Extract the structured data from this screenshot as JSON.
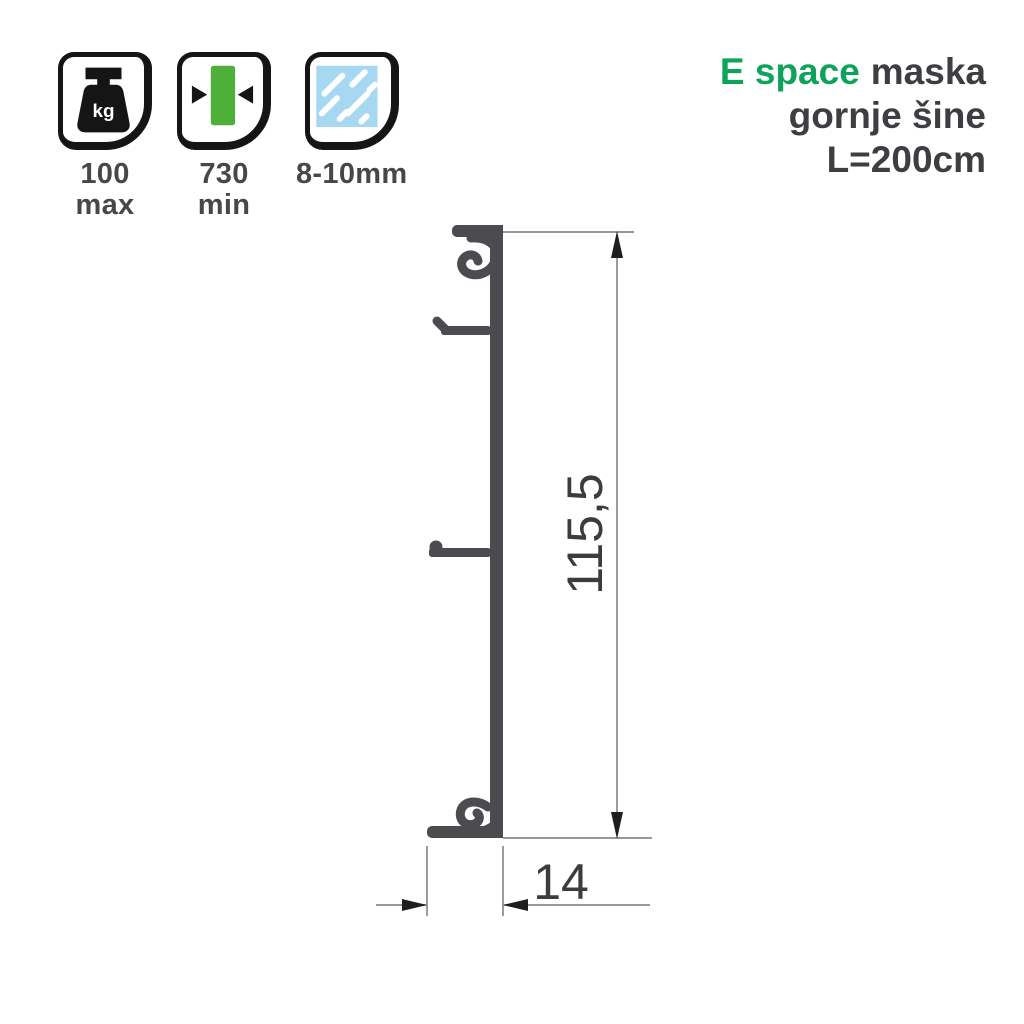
{
  "colors": {
    "ink": "#151515",
    "accent-green": "#0ea35a",
    "icon-green": "#4eb038",
    "glass-blue": "#a6d8f2",
    "text-dark": "#3e3e42",
    "label-gray": "#474747",
    "profile-gray": "#4b4b50",
    "dim-line-gray": "#8a8a8a",
    "dim-arrow-dark": "#1e1e1e",
    "dim-text": "#3c3c3c"
  },
  "header": {
    "title": {
      "brand": "E space",
      "rest": "maska",
      "line2": "gornje šine",
      "line3": "L=200cm"
    }
  },
  "spec_icons": [
    {
      "icon": "weight-kg-icon",
      "icon_text": "kg",
      "value": "100",
      "unit": "max"
    },
    {
      "icon": "panel-width-arrows-icon",
      "value": "730",
      "unit": "min"
    },
    {
      "icon": "glass-pane-icon",
      "value": "8-10mm",
      "unit": ""
    }
  ],
  "drawing": {
    "dim_height": {
      "value": "115,5"
    },
    "dim_width": {
      "value": "14"
    }
  }
}
